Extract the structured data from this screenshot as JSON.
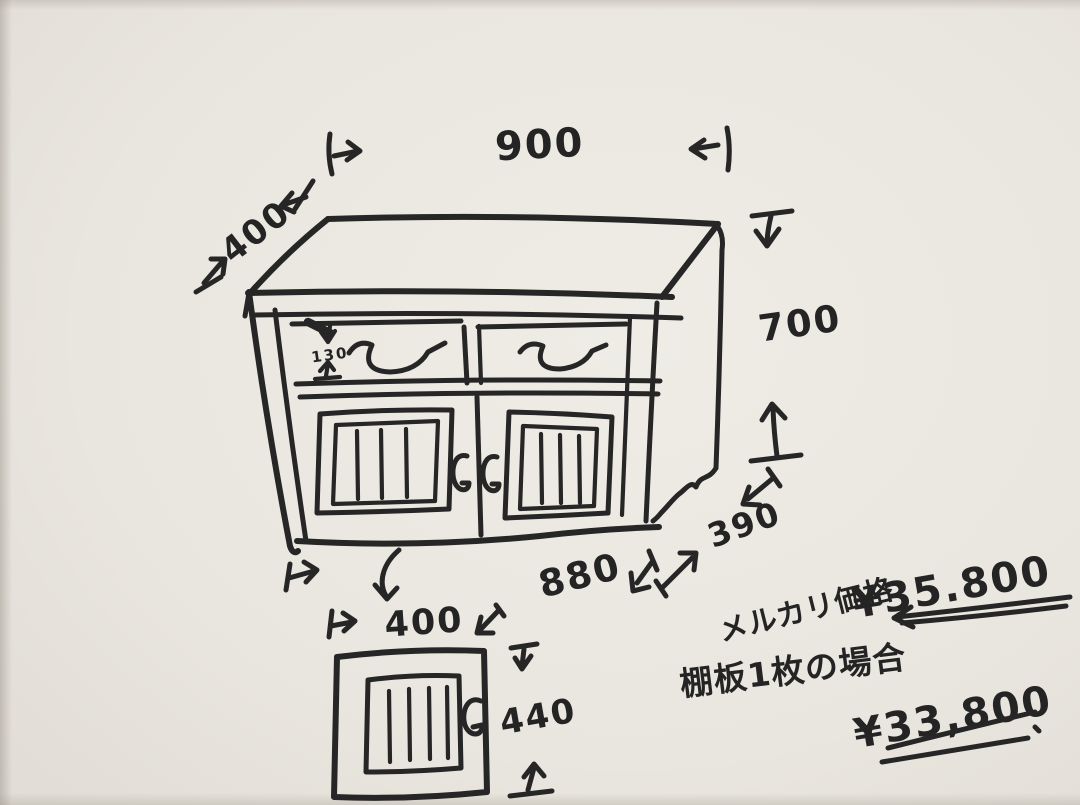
{
  "drawing": {
    "cabinet_dimensions": {
      "top_width_mm": "900",
      "top_depth_mm": "400",
      "height_mm": "700",
      "drawer_front_mm": "130",
      "base_depth_mm": "390",
      "base_width_mm": "880"
    },
    "door_dimensions": {
      "width_mm": "400",
      "height_mm": "440"
    },
    "pricing": {
      "mercari_label": "メルカリ価格",
      "mercari_price": "¥35.800",
      "shelf_case_label": "棚板1枚の場合",
      "shelf_case_price": "¥33,800"
    },
    "colors": {
      "paper": "#e9e6df",
      "ink": "#262626"
    }
  }
}
